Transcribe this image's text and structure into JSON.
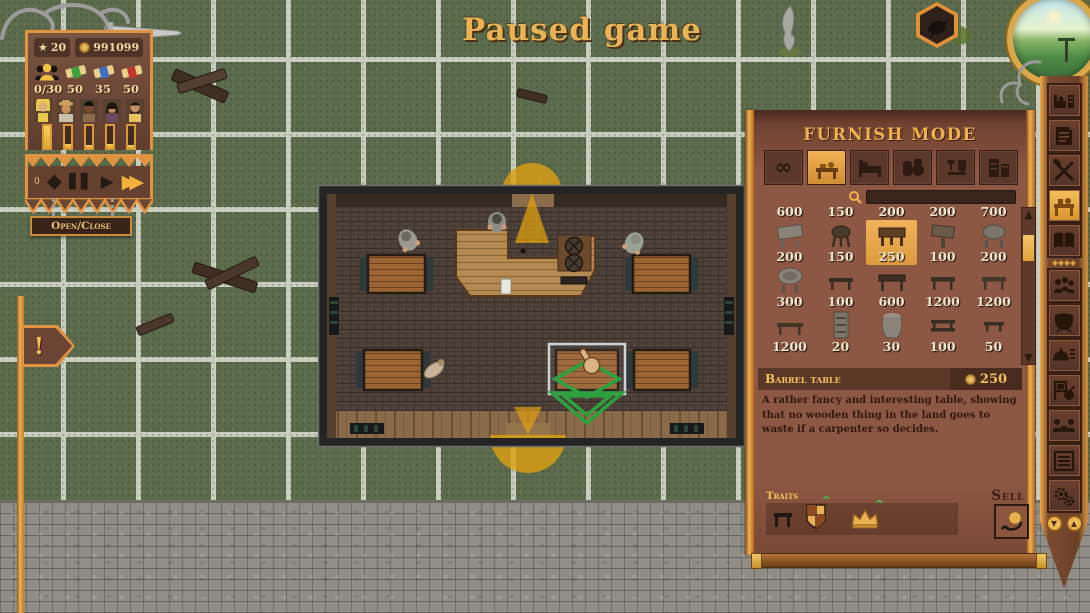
{
  "window": {
    "title": "Paused game"
  },
  "hud": {
    "level": "20",
    "gold": "991099",
    "resources": [
      {
        "icon": "patrons-icon",
        "value": "0/30"
      },
      {
        "icon": "green-scroll-icon",
        "value": "50"
      },
      {
        "icon": "blue-scroll-icon",
        "value": "35"
      },
      {
        "icon": "red-scroll-icon",
        "value": "50"
      }
    ],
    "speed_counter": "0",
    "open_close_label": "Open/Close",
    "alert_label": "!"
  },
  "furnish": {
    "title": "Furnish Mode",
    "close_label": "X",
    "tabs": [
      "all-items",
      "tables",
      "beds",
      "kegs",
      "decorations",
      "storage"
    ],
    "search_value": "",
    "price_rows": [
      [
        "600",
        "150",
        "200",
        "200",
        "700"
      ],
      [
        "200",
        "150",
        "250",
        "100",
        "200"
      ],
      [
        "300",
        "100",
        "600",
        "1200",
        "1200"
      ],
      [
        "1200",
        "20",
        "30",
        "100",
        "50"
      ]
    ],
    "selected": {
      "row": 1,
      "col": 2,
      "name": "Barrel table",
      "price": "250",
      "description": "A rather fancy and interesting table, showing that no wooden thing in the land goes to waste if a carpenter so decides."
    },
    "traits_label": "Traits",
    "sell_label": "Sell"
  },
  "toolbar": {
    "icons": [
      "rooms-icon",
      "blueprint-icon",
      "build-tools-icon",
      "furnish-icon",
      "recipes-book-icon",
      "staff-icon",
      "cauldron-icon",
      "menu-icon",
      "events-icon",
      "guests-icon",
      "ledger-icon",
      "settings-icon"
    ],
    "selected_icon": "furnish-icon"
  },
  "map_markers": {
    "badge": "raven-icon",
    "minimap": "world-minimap"
  },
  "colors": {
    "accent_gold": "#e8a84f",
    "panel_brown": "#8d5843",
    "gold_text": "#f0c35c",
    "selection_green": "#2fa03f",
    "grass": "#5d6b4d",
    "gridline": "#c9cec0",
    "orange_arc": "#dfa012"
  }
}
